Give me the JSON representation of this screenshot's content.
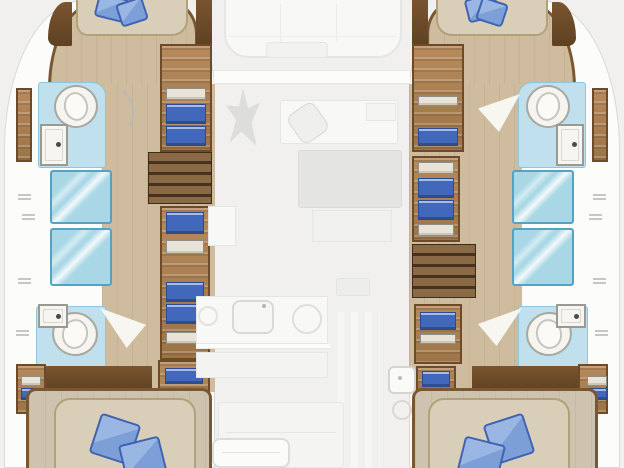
{
  "diagram": {
    "type": "boat-floorplan",
    "subject": "catamaran-yacht-deck-plan",
    "orientation": "bow-up",
    "hulls": {
      "port": {
        "side": "left",
        "rooms": [
          "forward-cabin",
          "forward-head",
          "hull-window-section",
          "companionway",
          "aft-head",
          "aft-cabin"
        ],
        "fixtures": [
          "double-berth-forward",
          "toilet-forward",
          "sink-vanity-forward",
          "wardrobe-forward",
          "hull-window-1",
          "hull-window-2",
          "dresser-blue-drawers",
          "companionway-stairs",
          "storage-cabinets",
          "toilet-aft",
          "sink-vanity-aft",
          "shower-door-swing",
          "aft-bulkhead",
          "aft-wardrobe",
          "double-berth-aft"
        ],
        "hull_window_count": 2,
        "pillows_per_berth": 2,
        "stair_treads": 5
      },
      "starboard": {
        "side": "right",
        "rooms": [
          "forward-cabin",
          "forward-head",
          "hull-window-section",
          "companionway",
          "aft-head",
          "aft-cabin"
        ],
        "fixtures": [
          "double-berth-forward",
          "toilet-forward",
          "sink-vanity-forward",
          "wardrobe-forward",
          "hull-window-1",
          "hull-window-2",
          "dresser-blue-drawers",
          "companionway-stairs",
          "storage-cabinets",
          "toilet-aft",
          "sink-vanity-aft",
          "door-swing-forward",
          "door-swing-aft",
          "aft-bulkhead",
          "aft-wardrobe",
          "double-berth-aft"
        ],
        "hull_window_count": 2,
        "pillows_per_berth": 2,
        "stair_treads": 5
      }
    },
    "center": {
      "rooms": [
        "salon-settee",
        "nav-station",
        "salon-table",
        "galley",
        "cockpit"
      ],
      "fixtures": [
        "settee-cushions",
        "settee-table",
        "windshield-band",
        "helm-plant",
        "nav-desk",
        "nav-chair",
        "nav-shelf",
        "salon-table",
        "salon-bench",
        "port-counter",
        "galley-counter",
        "galley-sink",
        "galley-burner",
        "galley-ring",
        "galley-lower-counter",
        "cockpit-teak-floor",
        "aft-wet-sink",
        "aft-ring",
        "aft-bench",
        "cockpit-table"
      ]
    }
  },
  "colors": {
    "bg": "#f1f0ef",
    "hull-deck": "#fcfcfb",
    "hull-edge": "#d9d9d6",
    "floor-tan": "#cfbc9e",
    "floor-tan2": "#cdc3ae",
    "wall-brown": "#7a5733",
    "wall-dark": "#6e4b28",
    "wood-mid": "#a9835a",
    "stair-tread": "#8a6a45",
    "stair-gap": "#46331d",
    "window-blue": "#a9d7e5",
    "window-edge": "#55a3c0",
    "bath-blue": "#bfe0ec",
    "bath-edge": "#8ec6da",
    "fixture-white": "#f5f4ef",
    "fixture-edge": "#a8a8a2",
    "bed-beige": "#d9cfb8",
    "bed-edge": "#b3a179",
    "pillow-blue": "#7b9fd6",
    "pillow-dark": "#3f62b5",
    "drawer-blue": "#4168bb",
    "drawer-white": "#e9e3d7",
    "center-white": "#f8f8f7",
    "center-line": "#e6e6e4",
    "center-gray": "#e4e4e2"
  }
}
